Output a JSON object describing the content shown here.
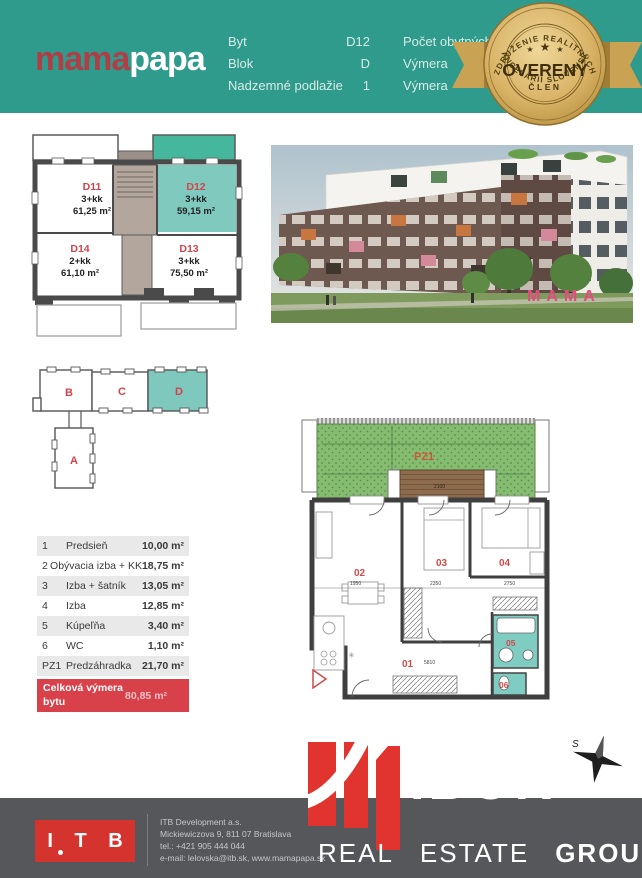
{
  "header": {
    "bg": "#2E9B8C",
    "logo": {
      "part1": "mama",
      "part2": "papa"
    },
    "fields_left": [
      {
        "label": "Byt",
        "value": "D12"
      },
      {
        "label": "Blok",
        "value": "D"
      },
      {
        "label": "Nadzemné podlažie",
        "value": "1"
      }
    ],
    "fields_right": [
      {
        "label": "Počet obytných"
      },
      {
        "label": "Výmera"
      },
      {
        "label": "Výmera"
      }
    ]
  },
  "badge": {
    "arc_top": "ZDRUŽENIE REALITNÝCH",
    "arc_bottom": "KANCELÁRIÍ SLOVENSKA",
    "stars": [
      "★",
      "★",
      "★"
    ],
    "title": "OVERENÝ",
    "subtitle": "ČLEN"
  },
  "floor_overview": {
    "units": [
      {
        "id": "D11",
        "layout": "3+kk",
        "area": "61,25 m²",
        "highlighted": false
      },
      {
        "id": "D12",
        "layout": "3+kk",
        "area": "59,15 m²",
        "highlighted": true
      },
      {
        "id": "D14",
        "layout": "2+kk",
        "area": "61,10 m²",
        "highlighted": false
      },
      {
        "id": "D13",
        "layout": "3+kk",
        "area": "75,50 m²",
        "highlighted": false
      }
    ]
  },
  "building_photo": {
    "sign": "MAMA"
  },
  "block_diagram": {
    "blocks": [
      {
        "id": "B",
        "highlighted": false
      },
      {
        "id": "C",
        "highlighted": false
      },
      {
        "id": "D",
        "highlighted": true
      },
      {
        "id": "A",
        "highlighted": false
      }
    ]
  },
  "room_table": {
    "rows": [
      {
        "num": "1",
        "name": "Predsieň",
        "area": "10,00 m²"
      },
      {
        "num": "2",
        "name": "Obývacia izba + KK",
        "area": "18,75 m²"
      },
      {
        "num": "3",
        "name": "Izba + šatník",
        "area": "13,05 m²"
      },
      {
        "num": "4",
        "name": "Izba",
        "area": "12,85 m²"
      },
      {
        "num": "5",
        "name": "Kúpeľňa",
        "area": "3,40 m²"
      },
      {
        "num": "6",
        "name": "WC",
        "area": "1,10 m²"
      },
      {
        "num": "PZ1",
        "name": "Predzáhradka",
        "area": "21,70 m²"
      }
    ],
    "total": {
      "label": "Celková výmera bytu",
      "value": "80,85 m²"
    }
  },
  "detail_plan": {
    "garden_label": "PZ1",
    "room_numbers": [
      "01",
      "02",
      "03",
      "04",
      "05",
      "06"
    ],
    "dims": {
      "terrace": "2100",
      "room02": "1950",
      "room03": "2350",
      "room04": "2750",
      "hall": "5810"
    }
  },
  "compass": {
    "label": "S"
  },
  "footer": {
    "itb_logo_text": "I T B",
    "lines": [
      "ITB Development a.s.",
      "Mickiewiczova 9, 811 07 Bratislava",
      "tel.: +421 905 444 044",
      "e-mail: lelovska@itb.sk, www.mamapapa.sk"
    ],
    "brand": {
      "name": "IBOR",
      "words": [
        "REAL",
        "ESTATE",
        "GROUP"
      ]
    }
  },
  "colors": {
    "teal": "#2E9B8C",
    "teal_light": "#7FC9BE",
    "teal_strong": "#45B79C",
    "red": "#D8414A",
    "gold": "#D9B467",
    "footer_gray": "#56575A",
    "itb_red": "#D5332E",
    "ibor_red": "#E2342E",
    "garden_green": "#86BC71",
    "terrace_brown": "#8D6B4D",
    "wall_dark": "#3F3F3F"
  }
}
